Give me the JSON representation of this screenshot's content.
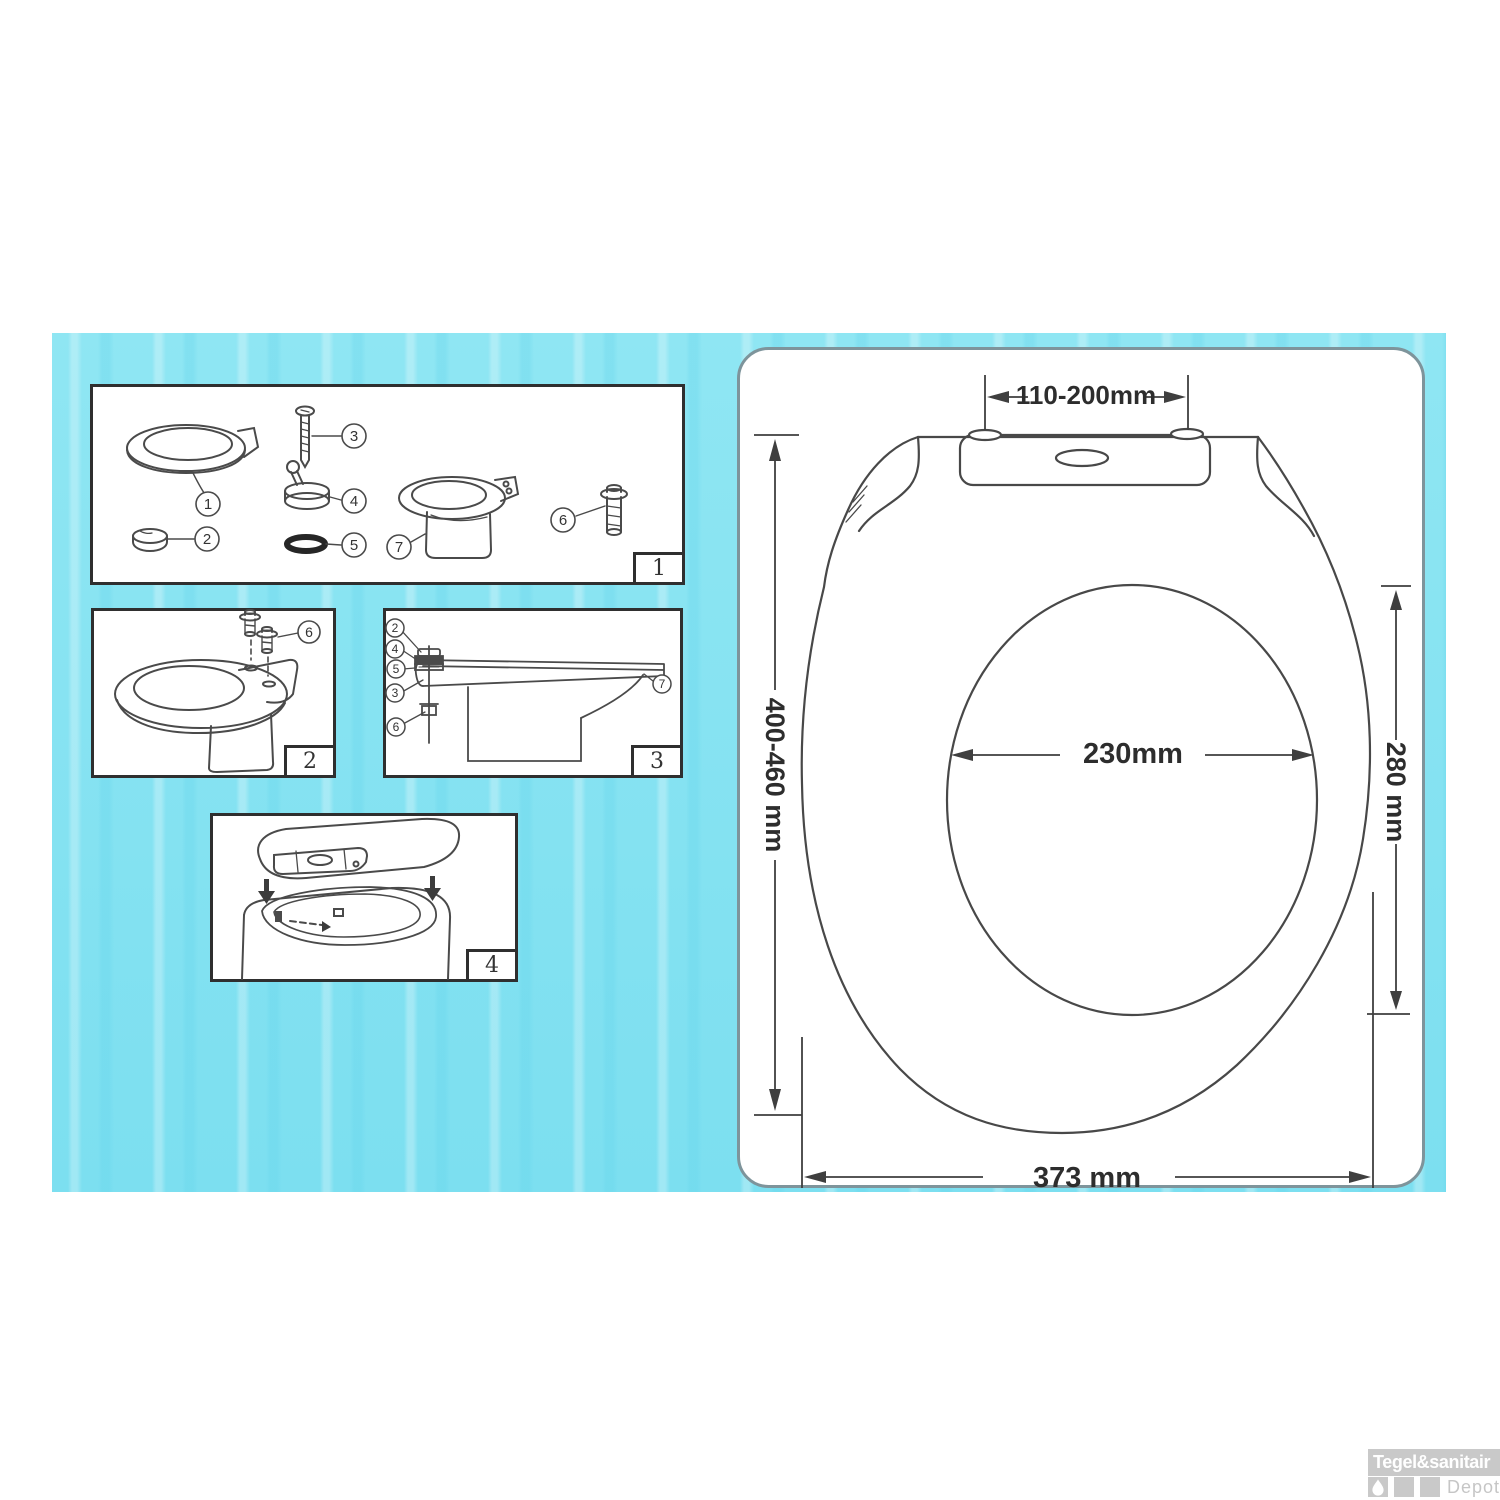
{
  "sheet": {
    "dimensions": {
      "hinge_hole_spacing": "110-200mm",
      "seat_length": "400-460 mm",
      "cutout_depth": "280 mm",
      "cutout_width": "230mm",
      "seat_width": "373 mm"
    }
  },
  "panels": {
    "p1": {
      "number": "1",
      "callouts": {
        "c1": "1",
        "c2": "2",
        "c3": "3",
        "c4": "4",
        "c5": "5",
        "c6": "6",
        "c7": "7"
      }
    },
    "p2": {
      "number": "2",
      "callouts": {
        "c6": "6"
      }
    },
    "p3": {
      "number": "3",
      "callouts": {
        "c2": "2",
        "c4": "4",
        "c5": "5",
        "c3": "3",
        "c6": "6",
        "c7": "7"
      }
    },
    "p4": {
      "number": "4"
    }
  },
  "watermark": {
    "brand": "Tegel&sanitair",
    "sub": "Depot"
  },
  "colors": {
    "canvas": "#84e2f0",
    "line": "#474747",
    "panel_border": "#2f2f2f",
    "watermark_gray": "#c9c9c9"
  }
}
